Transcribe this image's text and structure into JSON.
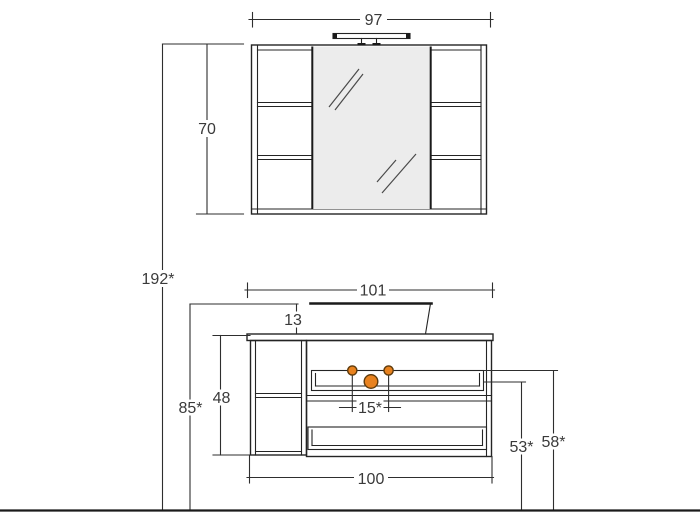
{
  "drawing": {
    "type": "technical-drawing",
    "subject": "Bathroom furniture set, front elevation: mirror cabinet with light fixture above a washbasin vanity unit with drawers and open shelves",
    "units": "cm",
    "colors": {
      "line": "#242424",
      "dimension_text": "#3a3a3a",
      "mirror_fill": "#ececec",
      "knob_fill": "#e8821f",
      "knob_stroke": "#5d3a0c",
      "background": "#ffffff"
    },
    "dimensions": {
      "mirror_cabinet_width": "97",
      "mirror_cabinet_height": "70",
      "total_height": "192*",
      "worktop_width": "101",
      "basin_height": "13",
      "base_cabinet_height": "48",
      "worktop_height_from_floor": "85*",
      "knob_spacing": "15*",
      "base_cabinet_width": "100",
      "clearance_height_inner": "53*",
      "clearance_height_top": "58*"
    }
  }
}
